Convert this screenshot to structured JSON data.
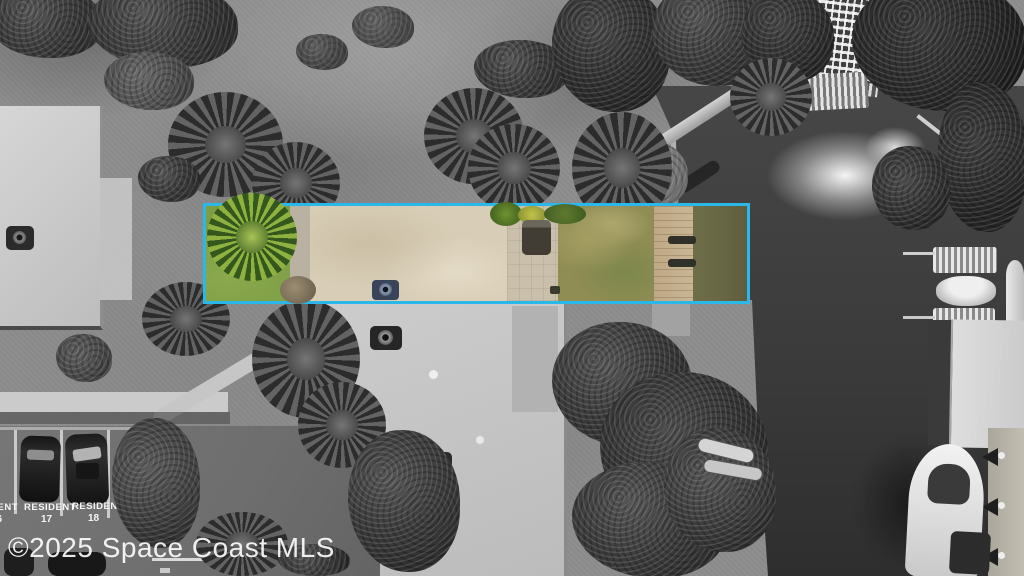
{
  "watermark": {
    "text": "©2025 Space Coast MLS"
  },
  "highlight": {
    "border_color": "#2bb8e9",
    "meaning": "property-lot-boundary"
  },
  "parking": {
    "spots": [
      {
        "label": "RESIDENT",
        "number": "16"
      },
      {
        "label": "RESIDENT",
        "number": "17"
      },
      {
        "label": "RESIDENT",
        "number": "18"
      }
    ]
  },
  "palette": {
    "highlight_cyan": "#2bb8e9",
    "lot_grass_green": "#7d9d44",
    "lot_roof_tan": "#d8cdb6",
    "lot_dock_wood": "#c9b694",
    "lot_water_olive": "#6b6a48",
    "canal_water_gray": "#414141"
  }
}
